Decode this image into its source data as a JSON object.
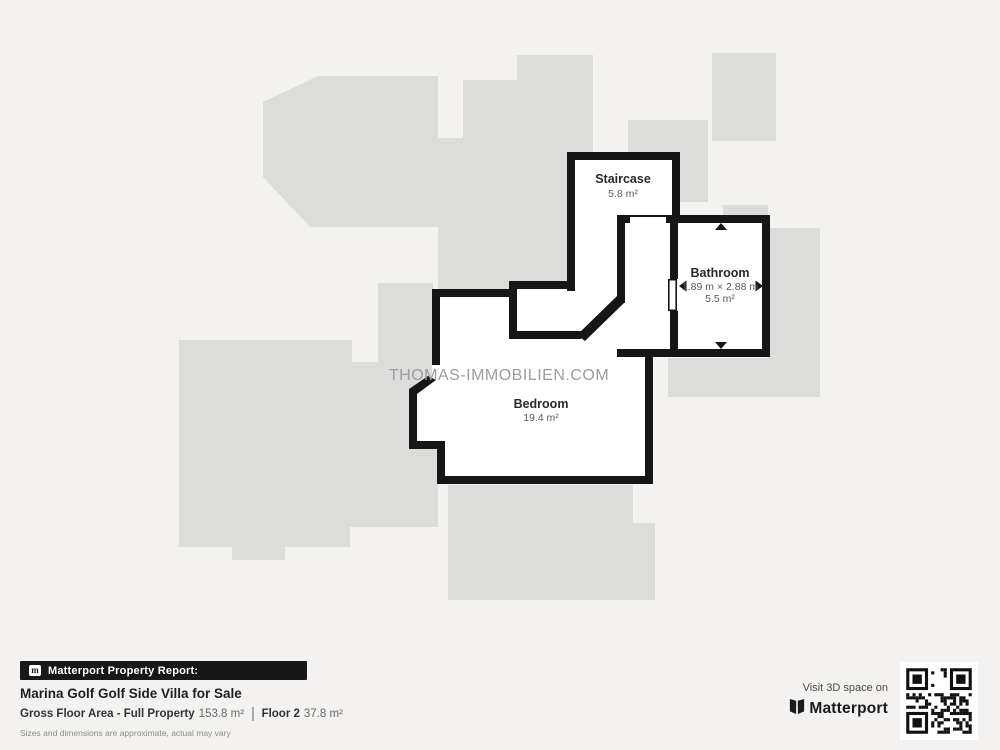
{
  "colors": {
    "background": "#f3f2f0",
    "silhouette": "#dcdcdb",
    "wall": "#161616",
    "room_fill": "#ffffff",
    "watermark": "#9c9c9c",
    "badge_bg": "#181818"
  },
  "watermark": "THOMAS-IMMOBILIEN.COM",
  "plan": {
    "rooms": [
      {
        "id": "staircase",
        "name": "Staircase",
        "area": "5.8 m²"
      },
      {
        "id": "bathroom",
        "name": "Bathroom",
        "dimensions": "1.89 m × 2.88 m",
        "area": "5.5 m²"
      },
      {
        "id": "bedroom",
        "name": "Bedroom",
        "area": "19.4 m²"
      }
    ]
  },
  "footer": {
    "report_badge": "Matterport Property Report:",
    "property_title": "Marina Golf Golf Side Villa for Sale",
    "gross_label": "Gross Floor Area - Full Property",
    "gross_value": "153.8 m²",
    "floor_label": "Floor 2",
    "floor_value": "37.8 m²",
    "disclaimer": "Sizes and dimensions are approximate, actual may vary",
    "visit_text": "Visit 3D space on",
    "brand": "Matterport",
    "badge_icon_letter": "m"
  }
}
